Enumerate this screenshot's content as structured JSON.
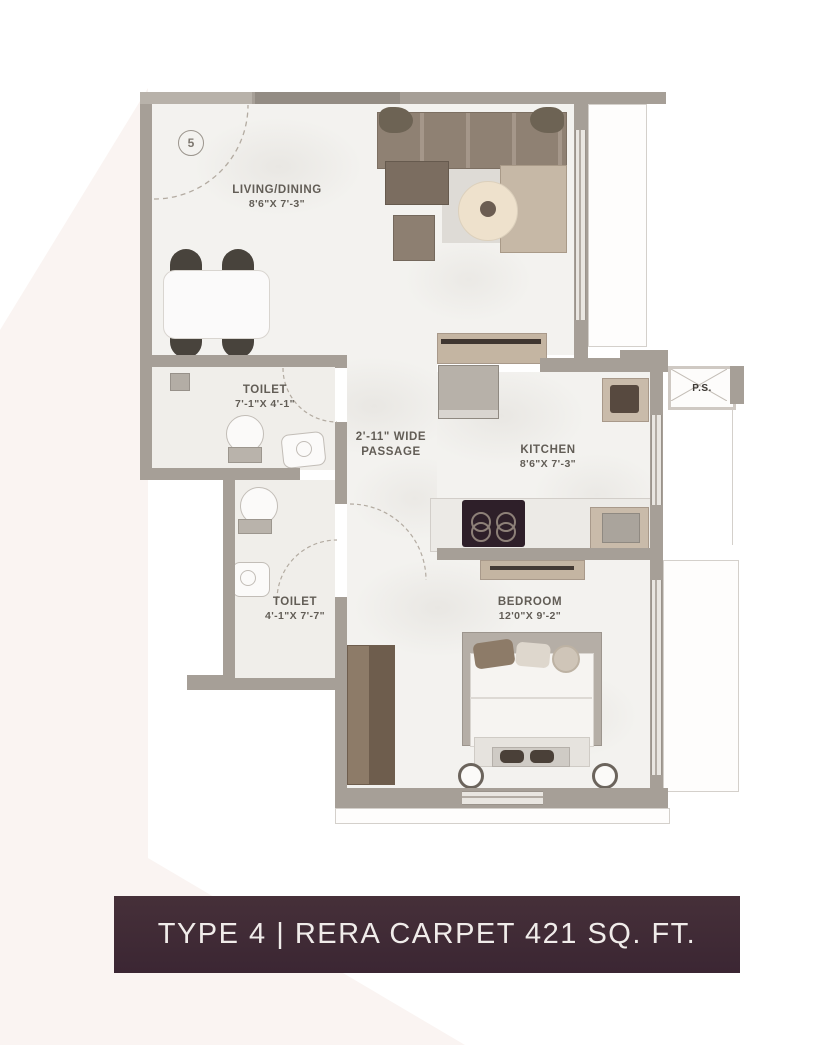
{
  "banner": {
    "text": "TYPE 4 | RERA CARPET 421 SQ. FT.",
    "bg_color": "#412a38",
    "text_color": "#f0ecea"
  },
  "entrance": {
    "door_number": "5"
  },
  "rooms": {
    "living": {
      "name": "LIVING/DINING",
      "dims": "8'6\"X 7'-3\""
    },
    "toilet1": {
      "name": "TOILET",
      "dims": "7'-1\"X 4'-1\""
    },
    "passage": {
      "line1": "2'-11\" WIDE",
      "line2": "PASSAGE"
    },
    "kitchen": {
      "name": "KITCHEN",
      "dims": "8'6\"X 7'-3\""
    },
    "toilet2": {
      "name": "TOILET",
      "dims": "4'-1\"X 7'-7\""
    },
    "bedroom": {
      "name": "BEDROOM",
      "dims": "12'0\"X 9'-2\""
    },
    "ps": {
      "name": "P.S."
    }
  },
  "colors": {
    "wall": "#a69f97",
    "floor": "#f3f2ef",
    "wood_accent": "#8d7b68",
    "banner": "#412a38",
    "watermark": "#faf4f2"
  }
}
